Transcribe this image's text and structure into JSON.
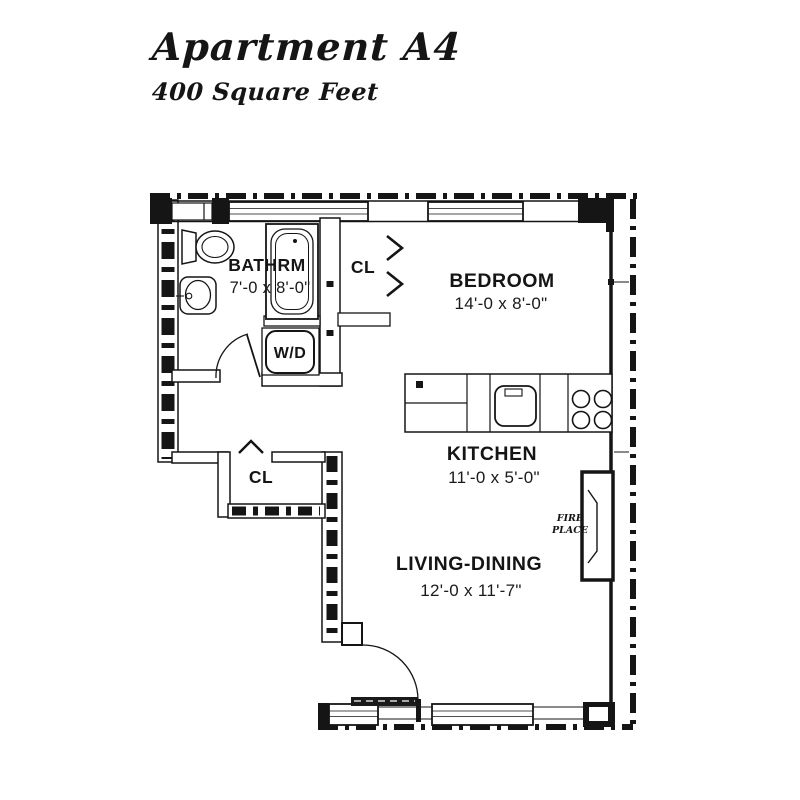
{
  "title": {
    "heading": "Apartment A4",
    "subheading": "400 Square Feet"
  },
  "rooms": {
    "bathroom": {
      "label": "BATHRM",
      "dims": "7'-0 x 8'-0\""
    },
    "bedroom": {
      "label": "BEDROOM",
      "dims": "14'-0 x 8'-0\""
    },
    "kitchen": {
      "label": "KITCHEN",
      "dims": "11'-0 x 5'-0\""
    },
    "living_dining": {
      "label": "LIVING-DINING",
      "dims": "12'-0 x 11'-7\""
    },
    "closet_upper": {
      "label": "CL"
    },
    "closet_hall": {
      "label": "CL"
    },
    "washer_dryer": {
      "label": "W/D"
    },
    "fireplace": {
      "line1": "FIRE",
      "line2": "PLACE"
    }
  },
  "colors": {
    "ink": "#151515",
    "paper": "#ffffff"
  }
}
